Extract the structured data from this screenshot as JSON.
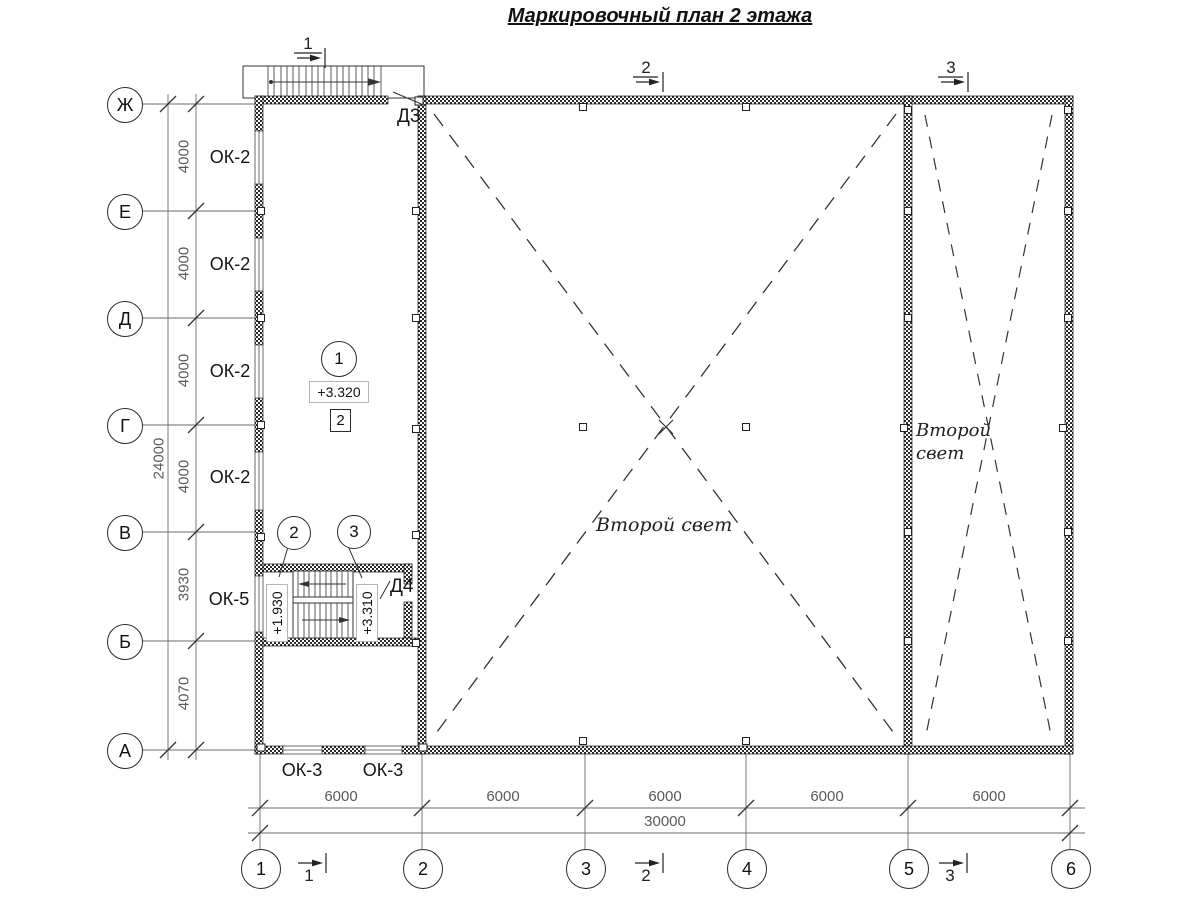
{
  "title": "Маркировочный план 2 этажа",
  "axes": {
    "rows": [
      "Ж",
      "Е",
      "Д",
      "Г",
      "В",
      "Б",
      "А"
    ],
    "cols": [
      "1",
      "2",
      "3",
      "4",
      "5",
      "6"
    ]
  },
  "dims": {
    "left": [
      "4000",
      "4000",
      "4000",
      "4000",
      "3930",
      "4070"
    ],
    "left_total": "24000",
    "bottom": [
      "6000",
      "6000",
      "6000",
      "6000",
      "6000"
    ],
    "bottom_total": "30000"
  },
  "windows": {
    "left": [
      "ОК-2",
      "ОК-2",
      "ОК-2",
      "ОК-2",
      "ОК-5"
    ],
    "bottom": [
      "ОК-3",
      "ОК-3"
    ]
  },
  "doors": {
    "d3": "Д3",
    "d4": "Д4"
  },
  "marks": {
    "room_circle": "1",
    "room_elevation": "+3.320",
    "room_box": "2",
    "stair_circle_left": "2",
    "stair_circle_right": "3",
    "stair_elevation_left": "+1.930",
    "stair_elevation_right": "+3.310"
  },
  "sections": {
    "top": [
      "1",
      "2",
      "3"
    ],
    "bottom": [
      "1",
      "2",
      "3"
    ]
  },
  "zones": {
    "hall": "Второй свет",
    "right_line1": "Второй",
    "right_line2": "свет"
  }
}
